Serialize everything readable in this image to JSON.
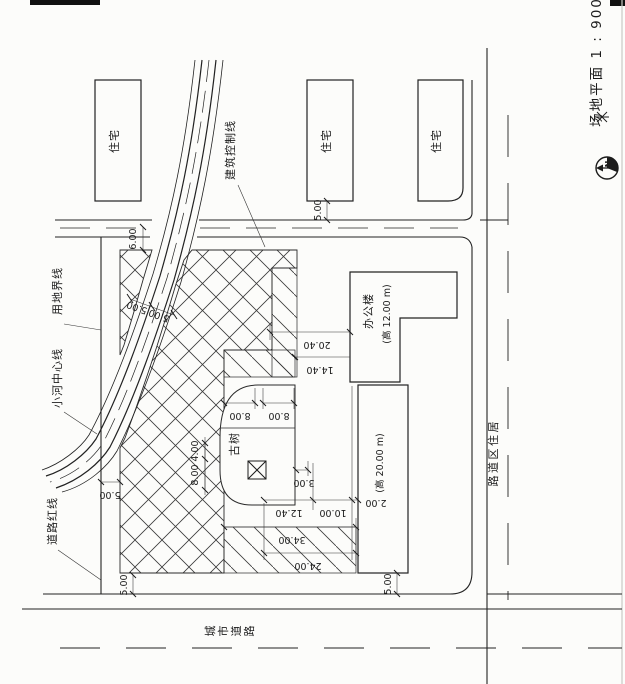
{
  "title": "场地平面 1 : 900",
  "north_arrow": {
    "label": "N"
  },
  "roads": {
    "city_road": "城市道路",
    "residential_road": "居住区道路"
  },
  "boundary_labels": {
    "site_boundary": "用地界线",
    "river_centerline": "小河中心线",
    "road_red_line": "道路红线",
    "building_control_line": "建筑控制线"
  },
  "buildings": {
    "residential_1": "住宅",
    "residential_2": "住宅",
    "residential_3": "住宅",
    "office_name": "办公楼",
    "office_height": "(高 12.00 m)",
    "tall_height": "(高 20.00 m)",
    "ancient_tree": "古树"
  },
  "dims": {
    "top_setback": "5.00",
    "north_gap": "6.00",
    "river_left": "5.00",
    "river_right": "5.00",
    "west_setback": "5.00",
    "southwest": "5.00",
    "southeast": "5.00",
    "d2040": "20.40",
    "d1440": "14.40",
    "d800a": "8.00",
    "d800b": "8.00",
    "d400": "4.00",
    "d800c": "8.00",
    "d300": "3.00",
    "d1240": "12.40",
    "d1000": "10.00",
    "d200": "2.00",
    "d3400": "34.00",
    "d2400": "24.00"
  },
  "colors": {
    "ink": "#1c1c1c",
    "paper": "#fcfcfa"
  }
}
